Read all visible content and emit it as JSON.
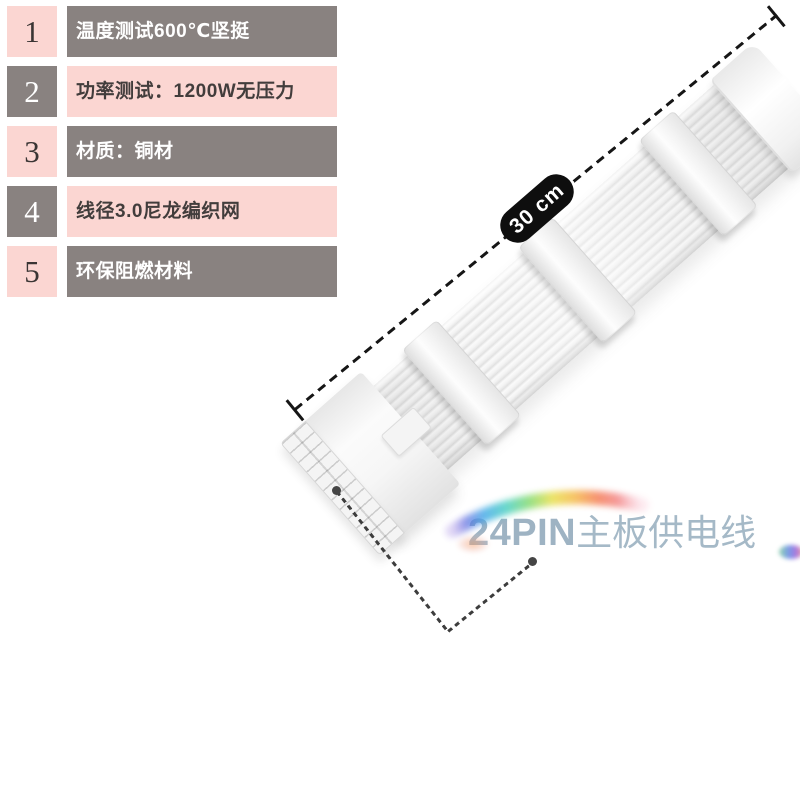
{
  "canvas": {
    "background": "#ffffff"
  },
  "features": {
    "items": [
      {
        "num": "1",
        "text": "温度测试600℃坚挺"
      },
      {
        "num": "2",
        "text": "功率测试：1200W无压力"
      },
      {
        "num": "3",
        "text": "材质：铜材"
      },
      {
        "num": "4",
        "text": "线径3.0尼龙编织网"
      },
      {
        "num": "5",
        "text": "环保阻燃材料"
      }
    ],
    "palette": {
      "pink": "#fbd6d2",
      "gray": "#898280",
      "dark_text": "#423d3c",
      "light_text": "#ffffff"
    }
  },
  "measurement": {
    "label": "30 cm",
    "badge_bg": "#0e0e0e",
    "badge_text_color": "#ffffff",
    "line_color": "#161616"
  },
  "caption": {
    "model": "24PIN",
    "name": "主板供电线",
    "color": "#a0b5c4"
  }
}
